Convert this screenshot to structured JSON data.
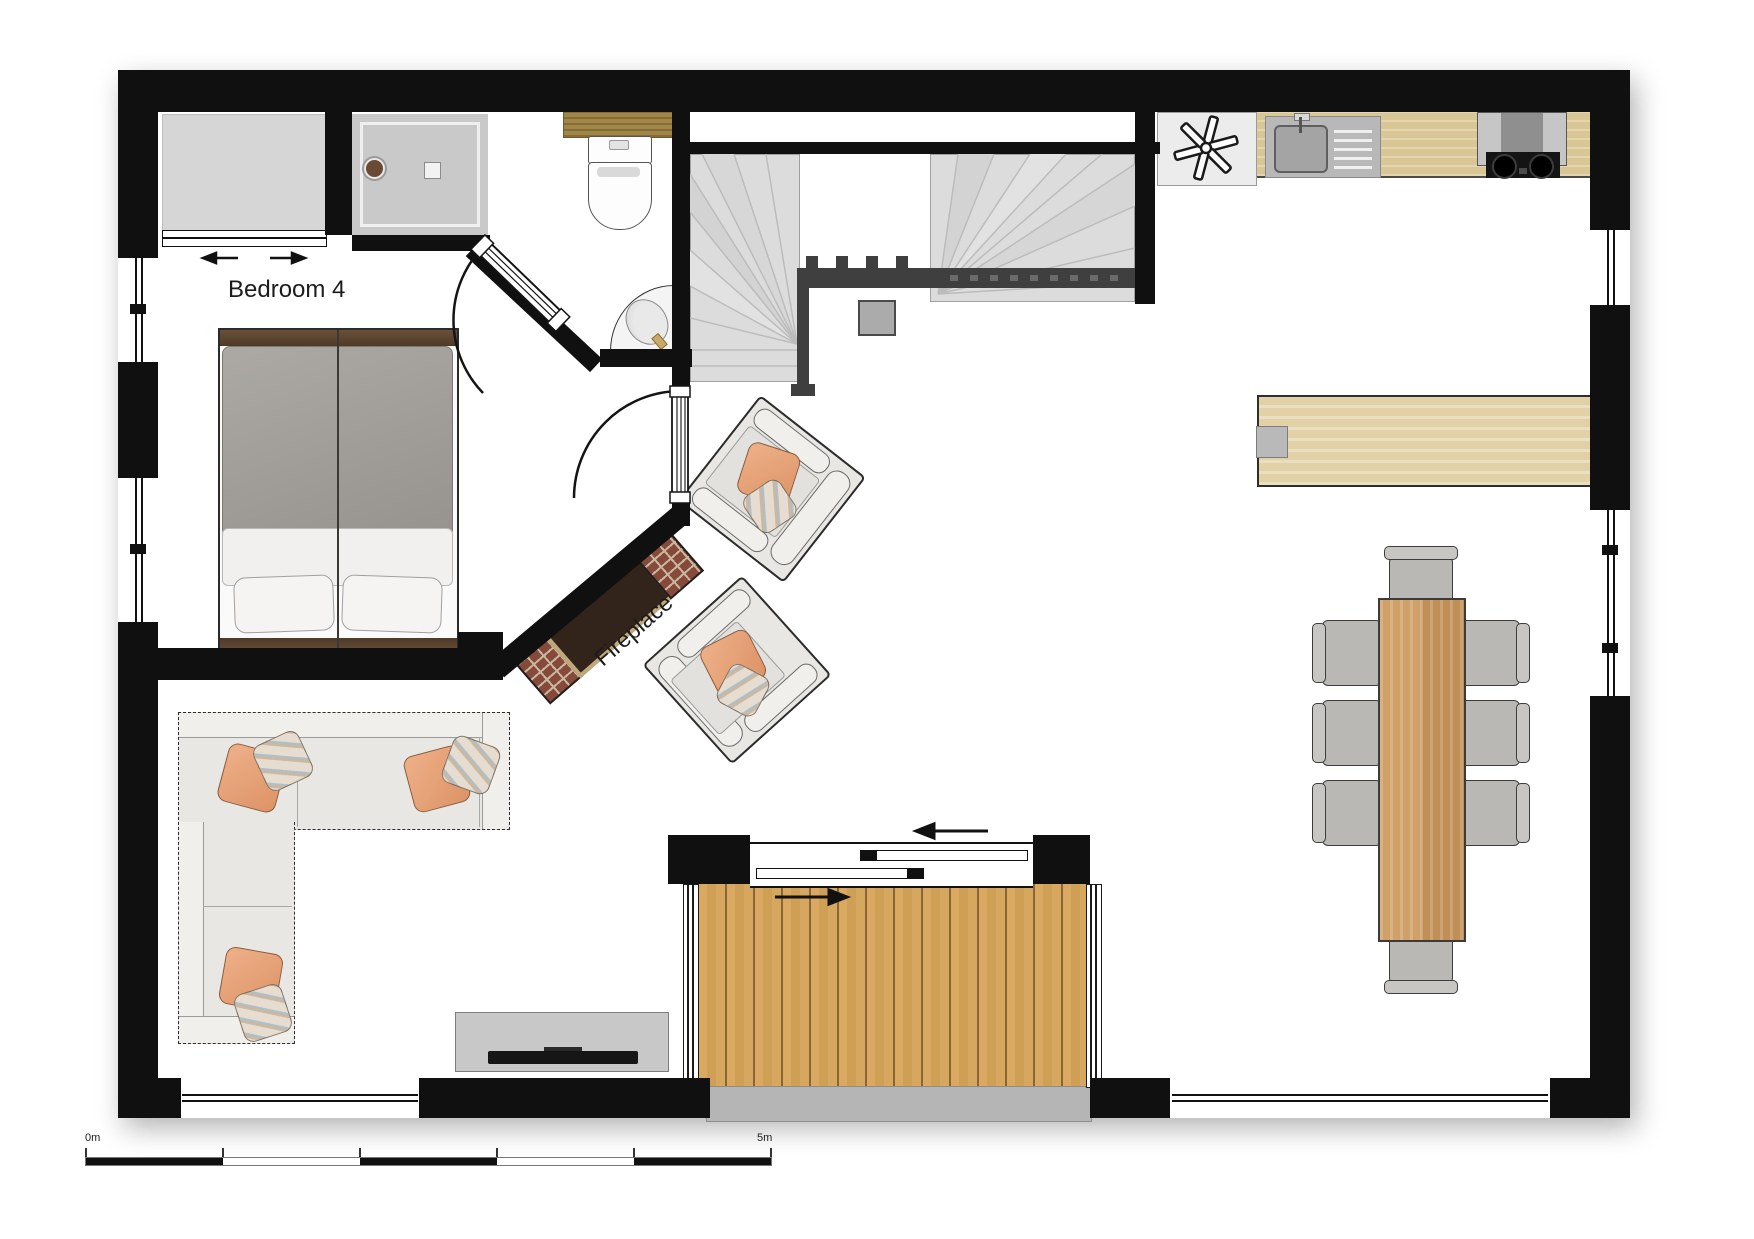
{
  "plan": {
    "type": "floor-plan",
    "labels": {
      "bedroom4": "Bedroom 4",
      "fireplace": "Fireplace"
    },
    "scale_bar": {
      "start_label": "0m",
      "end_label": "5m",
      "segments": 5
    },
    "palette": {
      "wall": "#101010",
      "floor": "#ffffff",
      "fixture_gray": "#d6d6d6",
      "stair_gray": "#dcdcdc",
      "railing_dark": "#3f3f3f",
      "counter_wood": "#d8c795",
      "shelf_wood": "#a08648",
      "bar_table_wood": "#e2d1a6",
      "dining_table_wood": "#c8995f",
      "deck_wood": "#d7a75e",
      "step_gray": "#b5b5b5",
      "sofa_fabric": "#e9e7e3",
      "chair_gray": "#bab8b4",
      "pillow_orange": "#e2a077",
      "duvet_gray": "#a3a09b",
      "bed_wood": "#4e3a28",
      "brick_red": "#86493a",
      "fireplace_insert": "#32241a",
      "tv_black": "#161616"
    },
    "icons": [
      {
        "name": "extractor-fan-icon"
      },
      {
        "name": "shower-head-icon"
      },
      {
        "name": "faucet-icon"
      },
      {
        "name": "slide-direction-arrow-icon"
      },
      {
        "name": "wardrobe-slide-arrow-icon"
      }
    ],
    "rooms": [
      "bedroom-4",
      "bathroom",
      "stairwell",
      "kitchen",
      "living-dining-room",
      "terrace-deck"
    ]
  }
}
